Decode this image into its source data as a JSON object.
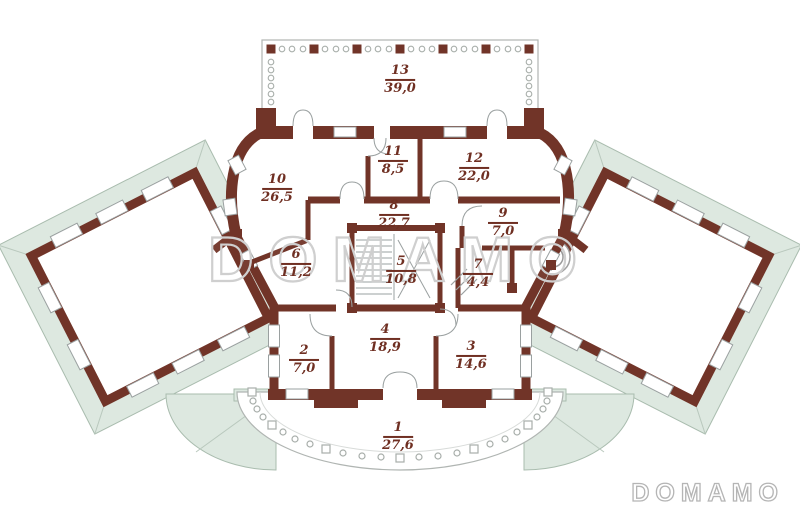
{
  "watermark": "DOMAMO",
  "logo": "DOMAMO",
  "colors": {
    "wall": "#713428",
    "mint": "#dde8e0",
    "mint_line": "#a9bcae",
    "label_text": "#6f2f22",
    "thin_line": "#9aa0a0",
    "baluster_line": "#a8aeaa"
  },
  "rooms": [
    {
      "number": "13",
      "area": "39,0"
    },
    {
      "number": "10",
      "area": "26,5"
    },
    {
      "number": "11",
      "area": "8,5"
    },
    {
      "number": "12",
      "area": "22,0"
    },
    {
      "number": "8",
      "area": "22,7"
    },
    {
      "number": "9",
      "area": "7,0"
    },
    {
      "number": "6",
      "area": "11,2"
    },
    {
      "number": "5",
      "area": "10,8"
    },
    {
      "number": "7",
      "area": "4,4"
    },
    {
      "number": "2",
      "area": "7,0"
    },
    {
      "number": "4",
      "area": "18,9"
    },
    {
      "number": "3",
      "area": "14,6"
    },
    {
      "number": "1",
      "area": "27,6"
    }
  ]
}
